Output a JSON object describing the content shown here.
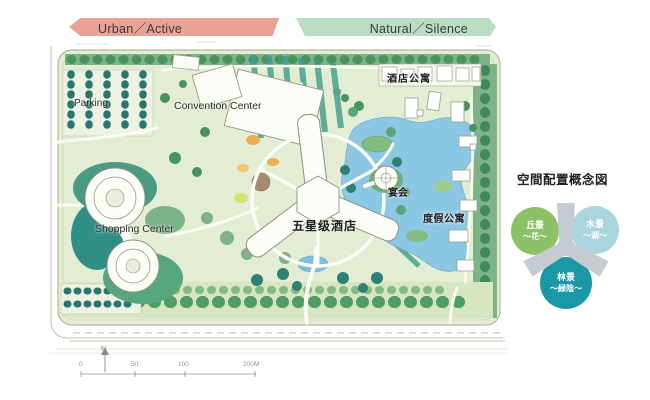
{
  "banners": {
    "urban": {
      "label": "Urban／Active",
      "color": "#eaa296"
    },
    "natural": {
      "label": "Natural／Silence",
      "color": "#b9dcc2"
    }
  },
  "plan": {
    "labels": {
      "parking": "Parking",
      "convention_center": "Convention Center",
      "shopping_center": "Shopping Center",
      "hotel": "五星级酒店",
      "banquet": "宴会",
      "hotel_apartments": "酒店公寓",
      "resort_apartments": "度假公寓"
    },
    "north_label": "N",
    "scale_ticks": [
      "0",
      "50",
      "100",
      "200M"
    ]
  },
  "concept": {
    "title": "空間配置概念図",
    "nodes": [
      {
        "id": "hill",
        "label": "丘景",
        "sub": "～花～",
        "color": "#8cc168"
      },
      {
        "id": "water",
        "label": "水景",
        "sub": "～湖～",
        "color": "#abd5de"
      },
      {
        "id": "forest",
        "label": "林景",
        "sub": "～緑陰～",
        "color": "#1b98a6"
      }
    ]
  },
  "colors": {
    "lake": "#8cc8e4",
    "lawn": "#e3edd3",
    "stripe_teal": "#3f9d8a",
    "tree_dark": "#27776e",
    "concept_y_gray": "#c5cbd1"
  }
}
